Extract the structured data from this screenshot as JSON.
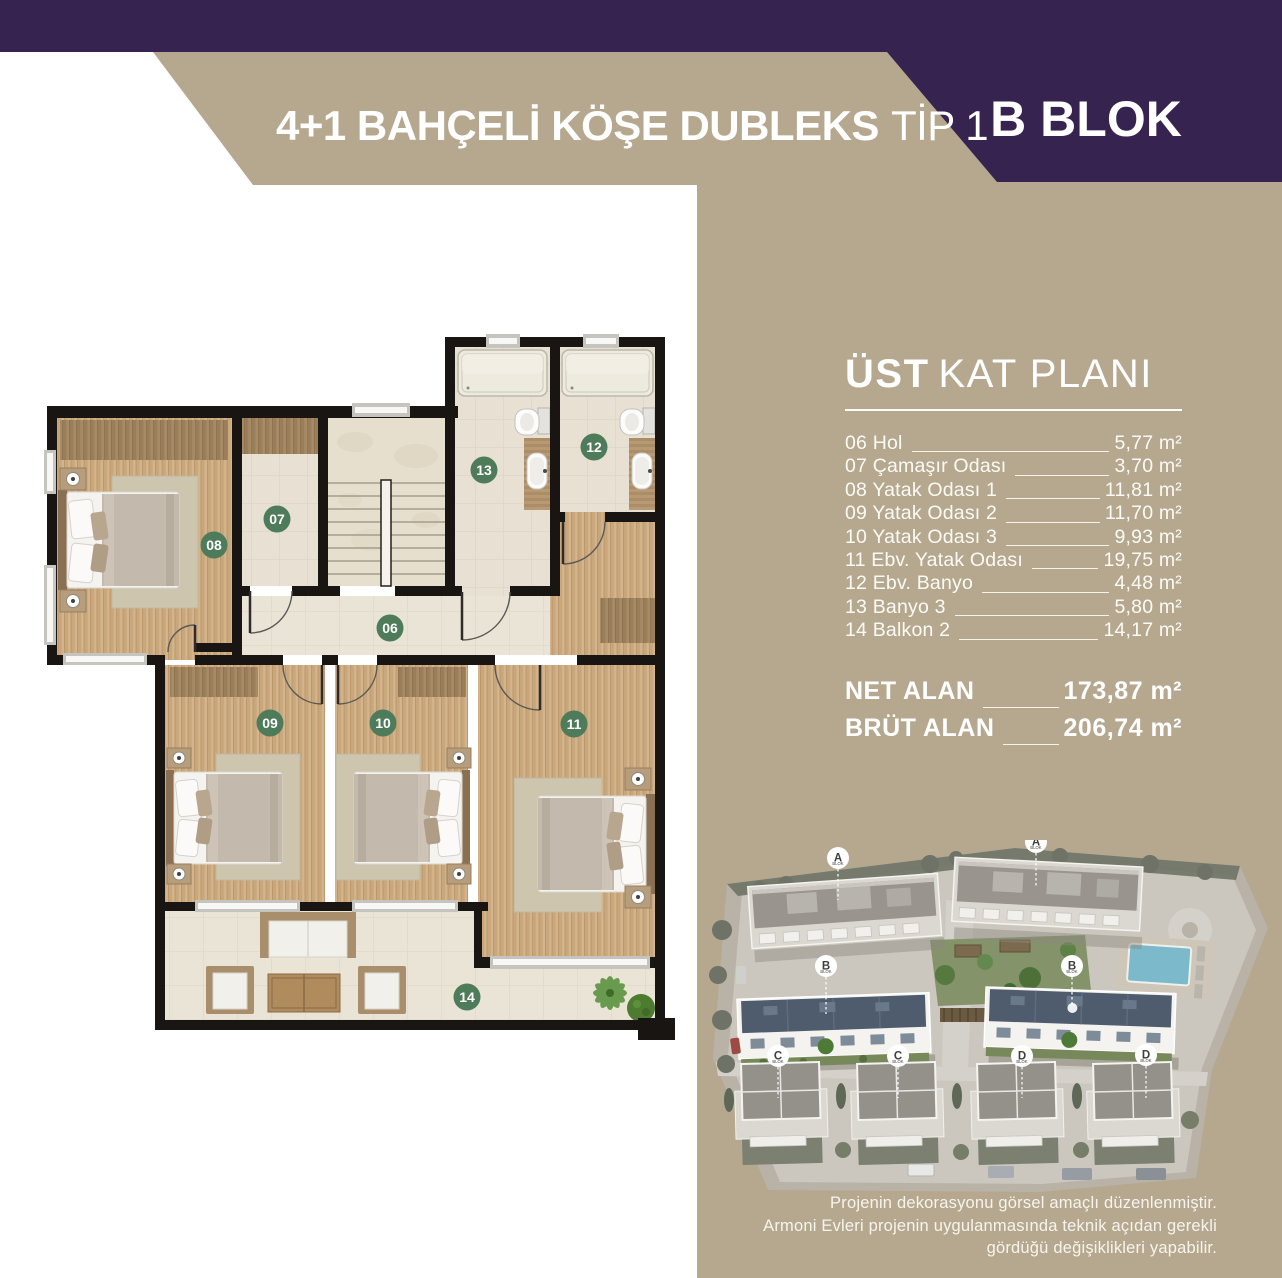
{
  "header": {
    "title_main": "4+1 BAHÇELİ KÖŞE DUBLEKS",
    "title_sub": "TİP 1",
    "block": "B BLOK"
  },
  "panel": {
    "title_bold": "ÜST",
    "title_rest": "KAT PLANI",
    "rooms": [
      {
        "label": "06 Hol",
        "area": "5,77 m²"
      },
      {
        "label": "07 Çamaşır Odası",
        "area": "3,70 m²"
      },
      {
        "label": "08 Yatak Odası 1",
        "area": "11,81 m²"
      },
      {
        "label": "09 Yatak Odası 2",
        "area": "11,70 m²"
      },
      {
        "label": "10 Yatak Odası 3",
        "area": "9,93 m²"
      },
      {
        "label": "11 Ebv. Yatak Odası",
        "area": "19,75 m²"
      },
      {
        "label": "12 Ebv. Banyo",
        "area": "4,48 m²"
      },
      {
        "label": "13 Banyo 3",
        "area": "5,80 m²"
      },
      {
        "label": "14 Balkon 2",
        "area": "14,17 m²"
      }
    ],
    "totals": [
      {
        "label": "NET ALAN",
        "area": "173,87 m²"
      },
      {
        "label": "BRÜT ALAN",
        "area": "206,74 m²"
      }
    ]
  },
  "plan": {
    "badges": [
      {
        "num": "06"
      },
      {
        "num": "07"
      },
      {
        "num": "08"
      },
      {
        "num": "09"
      },
      {
        "num": "10"
      },
      {
        "num": "11"
      },
      {
        "num": "12"
      },
      {
        "num": "13"
      },
      {
        "num": "14"
      }
    ]
  },
  "site": {
    "pin_sub": "BLOK",
    "pins": [
      {
        "letter": "A"
      },
      {
        "letter": "A"
      },
      {
        "letter": "B"
      },
      {
        "letter": "B"
      },
      {
        "letter": "C"
      },
      {
        "letter": "C"
      },
      {
        "letter": "D"
      },
      {
        "letter": "D"
      }
    ]
  },
  "disclaimer": {
    "line1": "Projenin dekorasyonu görsel amaçlı düzenlenmiştir.",
    "line2": "Armoni Evleri projenin uygulanmasında teknik açıdan gerekli gördüğü değişiklikleri yapabilir."
  },
  "colors": {
    "purple": "#372350",
    "beige": "#b5a88f",
    "badge_green": "#4e7b5a",
    "wall_black": "#181512",
    "roof_blue": "#4e5c6d"
  }
}
